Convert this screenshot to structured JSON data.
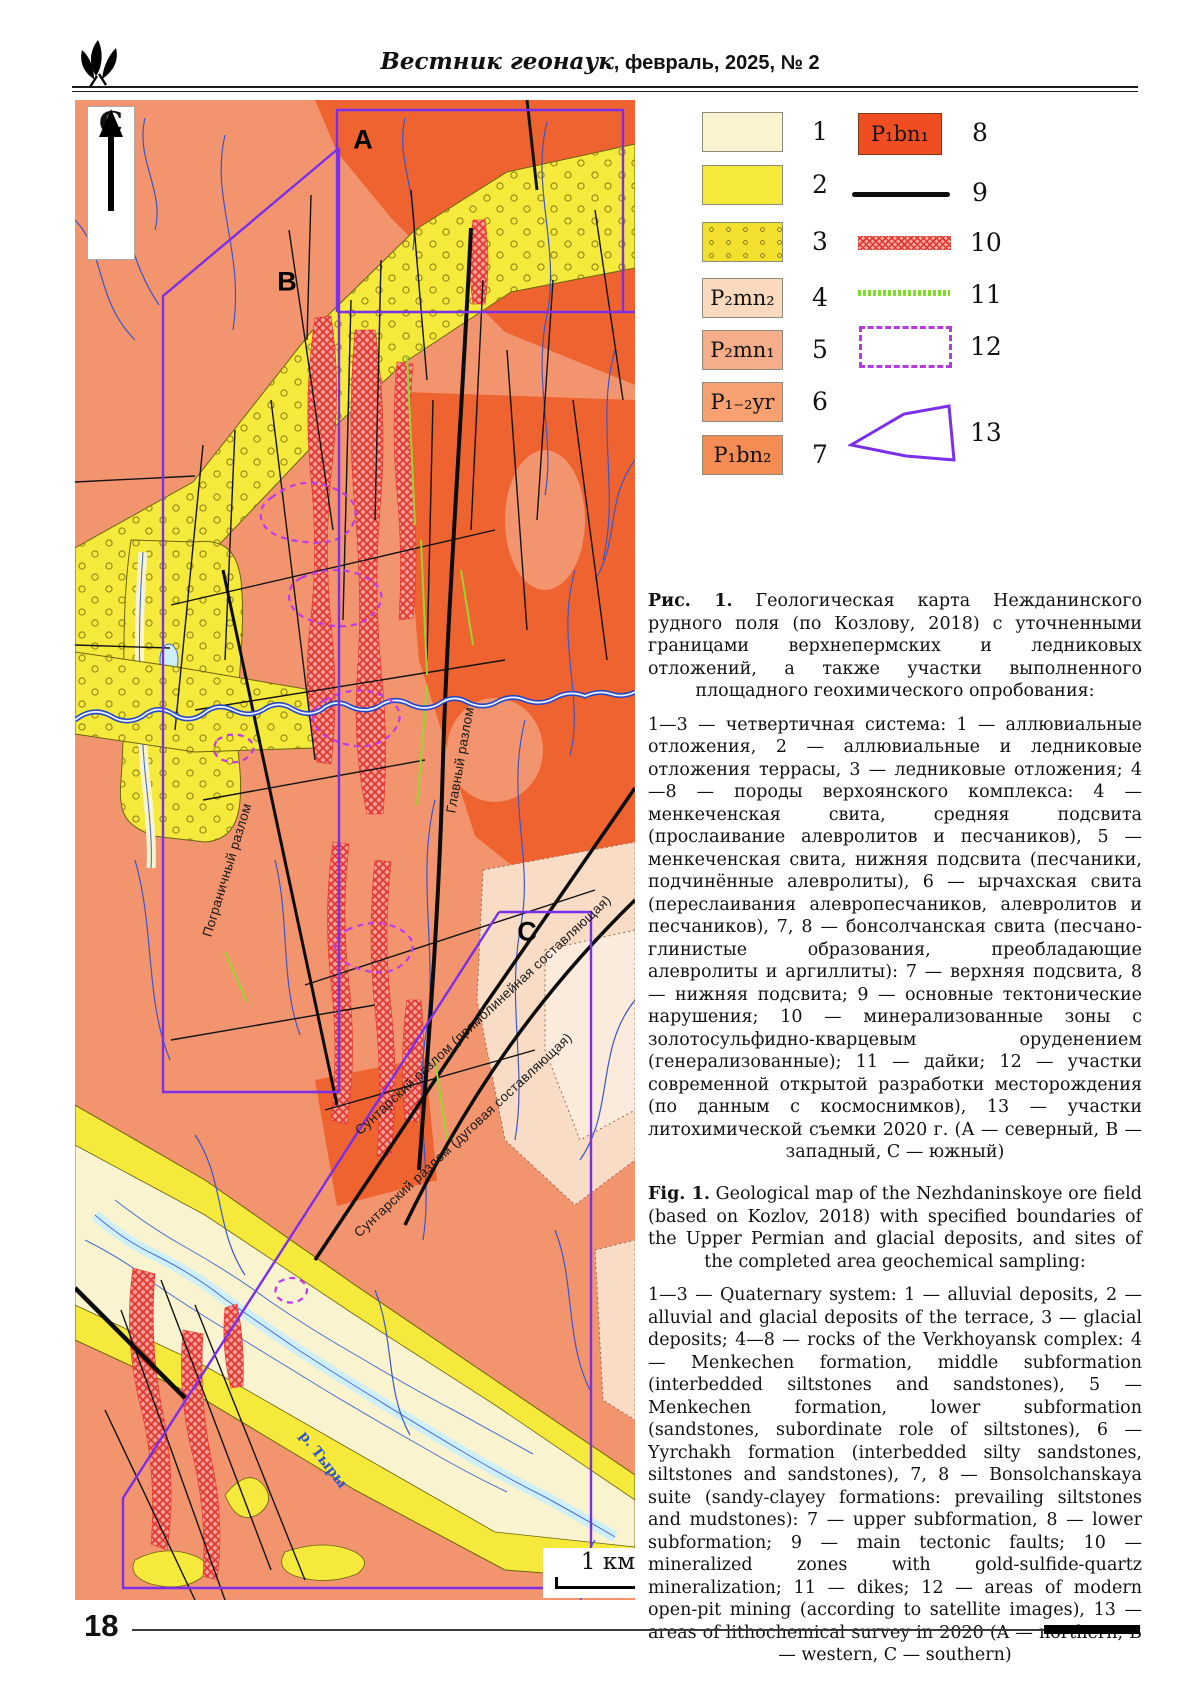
{
  "header": {
    "journal_script": "Вестник геонаук",
    "journal_rest": ", февраль, 2025, № 2"
  },
  "footer": {
    "page_number": "18"
  },
  "map": {
    "north_label": "С",
    "area_a": "A",
    "area_b": "B",
    "area_c": "С",
    "fault_pogranichny": "Пограничный разлом",
    "fault_glavny": "Главный разлом",
    "fault_suntar_straight": "Сунтарский разлом (прямолинейная составляющая)",
    "fault_suntar_arc": "Сунтарский разлом (дуговая составляющая)",
    "river_label": "р. Тыры",
    "scale_label": "1 км",
    "colors": {
      "background_salmon": "#F2946E",
      "orange": "#EE6330",
      "yellow": "#F5E93B",
      "cream": "#FAF3CF",
      "pale_pink": "#F8DCC6",
      "river_blue": "#2847C8",
      "light_blue": "#CFEFF7",
      "mineralized_red": "#E3342F",
      "dike_green": "#96D62E",
      "survey_purple": "#7B2FE8",
      "mining_purple": "#C03BE8",
      "fault_black": "#141414"
    }
  },
  "legend": {
    "items": [
      {
        "num": "1",
        "label": ""
      },
      {
        "num": "2",
        "label": ""
      },
      {
        "num": "3",
        "label": ""
      },
      {
        "num": "4",
        "label": "P₂mn₂"
      },
      {
        "num": "5",
        "label": "P₂mn₁"
      },
      {
        "num": "6",
        "label": "P₁₋₂yr"
      },
      {
        "num": "7",
        "label": "P₁bn₂"
      },
      {
        "num": "8",
        "label": "P₁bn₁"
      },
      {
        "num": "9",
        "label": ""
      },
      {
        "num": "10",
        "label": ""
      },
      {
        "num": "11",
        "label": ""
      },
      {
        "num": "12",
        "label": ""
      },
      {
        "num": "13",
        "label": ""
      }
    ]
  },
  "captions": {
    "ru": {
      "lead": "Рис. 1.",
      "title": "Геологическая карта Нежданинского рудного поля (по Козлову, 2018) с уточненными границами верхнепермских и ледниковых отложений, а также участки выполненного площадного геохимического опробования:",
      "body": "1—3 — четвертичная система: 1 — аллювиальные отложения, 2 — аллювиальные и ледниковые отложения террасы, 3 — ледниковые отложения; 4—8 — породы верхоянского комплекса: 4 — менкеченская свита, средняя подсвита (прослаивание алевролитов и песчаников), 5 — менкеченская свита, нижняя подсвита (песчаники, подчинённые алевролиты), 6 — ырчахская свита (переслаивания алевропесчаников, алевролитов и песчаников), 7, 8 — бонсолчанская свита (песчано-глинистые образования, преобладающие алевролиты и аргиллиты): 7 — верхняя подсвита, 8 — нижняя подсвита; 9 — основные тектонические нарушения; 10 — минерализованные зоны с золотосульфидно-кварцевым оруденением (генерализованные); 11 — дайки; 12 — участки современной открытой разработки месторождения (по данным с космоснимков), 13 — участки литохимической съемки 2020 г. (А — северный, В — западный, С — южный)"
    },
    "en": {
      "lead": "Fig. 1.",
      "title": "Geological map of the Nezhdaninskoye ore field (based on Kozlov, 2018) with specified boundaries of the Upper Permian and glacial deposits, and sites of the completed area geochemical sampling:",
      "body": "1—3 — Quaternary system: 1 — alluvial deposits, 2 — alluvial and glacial deposits of the terrace, 3 — glacial deposits; 4—8 — rocks of the Verkhoyansk complex: 4 — Menkechen formation, middle subformation (interbedded siltstones and sandstones), 5 — Menkechen formation, lower subformation (sandstones, subordinate role of siltstones), 6 — Yyrchakh formation (interbedded silty sandstones, siltstones and sandstones), 7, 8 — Bonsolchanskaya suite (sandy-clayey formations: prevailing siltstones and mudstones): 7 — upper subformation, 8 — lower subformation; 9 — main tectonic faults; 10 — mineralized zones with gold-sulfide-quartz mineralization; 11 — dikes; 12 — areas of modern open-pit mining (according to satellite images), 13 — areas of lithochemical survey in 2020 (A — northern, B — western, C — southern)"
    }
  }
}
